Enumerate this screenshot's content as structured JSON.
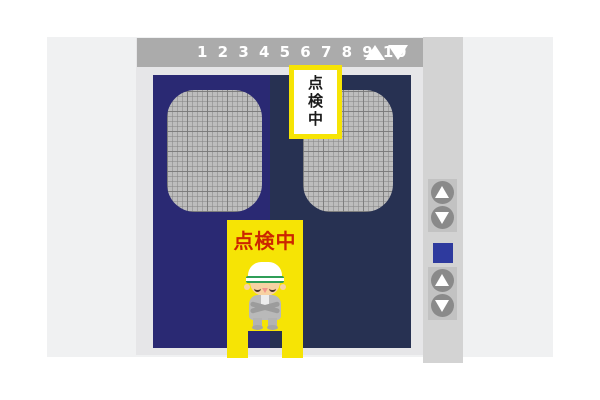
{
  "indicator_bar": {
    "floor_numbers": "1 2 3 4 5 6 7 8 9 10",
    "icons": [
      "up-triangle-icon",
      "down-triangle-icon"
    ]
  },
  "door_sign": {
    "text": "点検中"
  },
  "stand_sign": {
    "text": "点検中"
  },
  "call_panel": {
    "icons": [
      "up-button-icon",
      "down-button-icon",
      "up-button-icon",
      "down-button-icon"
    ],
    "lamp_color": "#2e3a9e"
  },
  "colors": {
    "wall": "#f0f1f2",
    "elevator_frame": "#e6e6e8",
    "indicator_bar_bg": "#ababab",
    "left_door": "#2a2973",
    "right_door": "#273152",
    "door_window_mesh": "#bdbdbd",
    "sign_yellow": "#f6e405",
    "sign_red_text": "#cc2600",
    "panel_strip": "#d3d3d3",
    "button_plate": "#c2c2c2",
    "button_circle": "#8a8a8a"
  }
}
